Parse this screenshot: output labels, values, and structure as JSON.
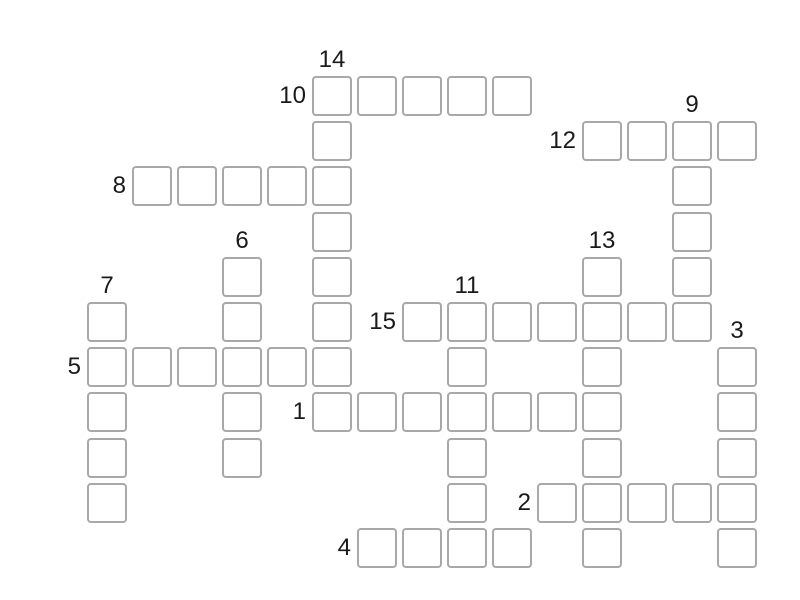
{
  "page": {
    "background_color": "#ffffff",
    "type": "crossword-puzzle-grid"
  },
  "grid": {
    "origin_x": 312,
    "origin_y": 76,
    "cell_size": 40,
    "cell_spacing_x": 45,
    "cell_spacing_y": 45.2,
    "cell_border_color": "#a8a8a8",
    "cell_fill_color": "#ffffff",
    "cell_corner_radius": 4,
    "label_color": "#1a1a1a",
    "label_font_size": 24
  },
  "entries": [
    {
      "number": "10",
      "direction": "across",
      "col": 0,
      "row": 0,
      "length": 5
    },
    {
      "number": "14",
      "direction": "down",
      "col": 0,
      "row": 0,
      "length": 8
    },
    {
      "number": "12",
      "direction": "across",
      "col": 6,
      "row": 1,
      "length": 4
    },
    {
      "number": "9",
      "direction": "down",
      "col": 8,
      "row": 1,
      "length": 5
    },
    {
      "number": "8",
      "direction": "across",
      "col": -4,
      "row": 2,
      "length": 5
    },
    {
      "number": "6",
      "direction": "down",
      "col": -2,
      "row": 4,
      "length": 5
    },
    {
      "number": "13",
      "direction": "down",
      "col": 6,
      "row": 4,
      "length": 7
    },
    {
      "number": "7",
      "direction": "down",
      "col": -5,
      "row": 5,
      "length": 5
    },
    {
      "number": "11",
      "direction": "down",
      "col": 3,
      "row": 5,
      "length": 6
    },
    {
      "number": "15",
      "direction": "across",
      "col": 2,
      "row": 5,
      "length": 7
    },
    {
      "number": "5",
      "direction": "across",
      "col": -5,
      "row": 6,
      "length": 6
    },
    {
      "number": "3",
      "direction": "down",
      "col": 9,
      "row": 6,
      "length": 5
    },
    {
      "number": "1",
      "direction": "across",
      "col": 0,
      "row": 7,
      "length": 7
    },
    {
      "number": "2",
      "direction": "across",
      "col": 5,
      "row": 9,
      "length": 5
    },
    {
      "number": "4",
      "direction": "across",
      "col": 1,
      "row": 10,
      "length": 4
    }
  ]
}
